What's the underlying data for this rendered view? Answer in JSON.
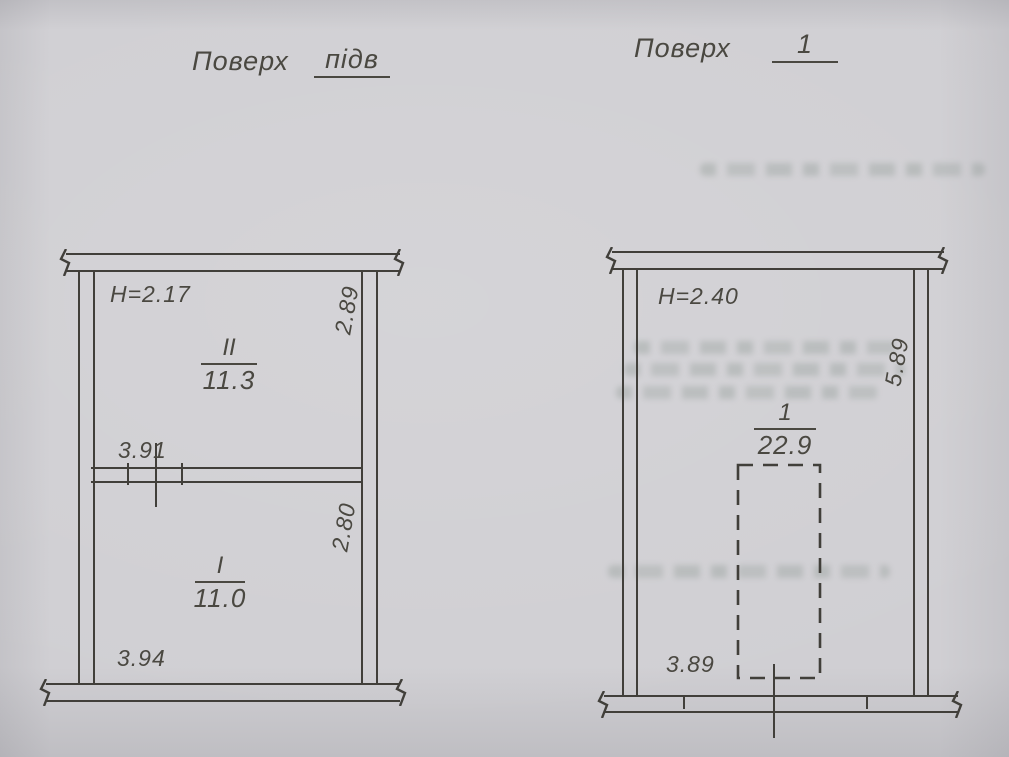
{
  "page": {
    "kind": "scanned floor plan sheet",
    "paper_color": "#d0cfd3",
    "ink_color": "#413f3a"
  },
  "plans": {
    "basement": {
      "title_label": "Поверх",
      "title_value": "підв",
      "rooms": {
        "upper": {
          "number": "II",
          "area": "11.3",
          "ceiling_height": "H=2.17",
          "width": "3.91",
          "depth": "2.89"
        },
        "lower": {
          "number": "I",
          "area": "11.0",
          "width": "3.94",
          "depth": "2.80"
        }
      }
    },
    "first": {
      "title_label": "Поверх",
      "title_value": "1",
      "room": {
        "number": "1",
        "area": "22.9",
        "ceiling_height": "H=2.40",
        "width": "3.89",
        "depth": "5.89"
      }
    }
  }
}
